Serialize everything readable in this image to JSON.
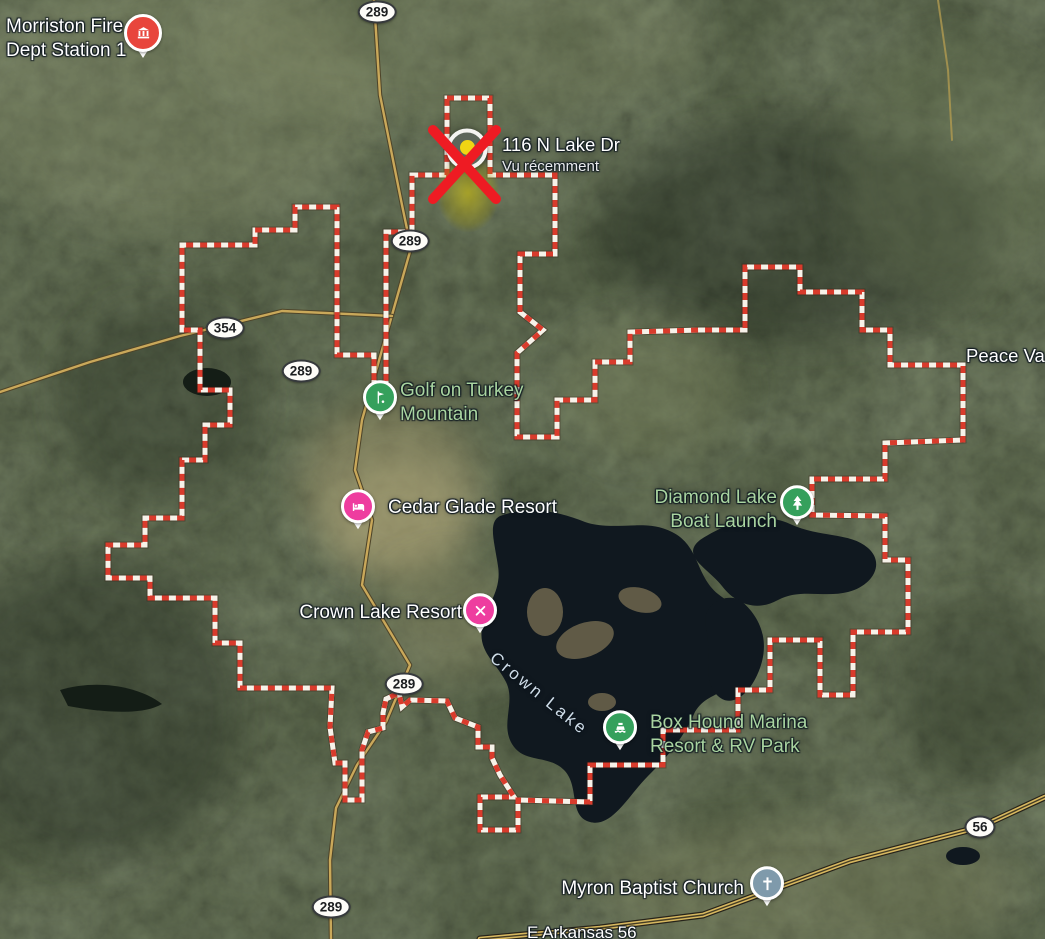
{
  "region": {
    "boundary_points": "447,98 490,98 490,175 555,175 555,254 520,254 520,312 543,330 517,353 517,437 557,437 557,400 595,400 595,362 630,362 630,332 700,330 745,330 745,267 800,267 800,292 862,292 862,330 890,330 890,365 963,365 963,440 885,443 885,479 812,479 812,515 885,516 885,560 908,560 908,632 853,632 853,695 820,695 820,640 770,640 770,690 738,690 738,730 663,730 663,765 590,765 590,802 518,800 518,830 480,830 480,797 514,797 500,775 492,758 492,747 478,747 478,727 455,718 447,701 410,700 402,707 399,693 386,699 383,713 383,728 368,732 362,750 362,800 345,800 345,763 335,763 330,727 332,688 240,688 240,643 215,643 215,598 150,598 150,578 108,578 108,545 145,545 145,518 182,518 182,460 205,460 205,425 230,425 230,390 200,390 200,330 182,330 182,245 255,245 255,230 295,230 295,207 337,207 337,355 374,355 374,392 386,392 386,232 412,232 412,175 447,175",
    "boundary_red": "#d93b2c",
    "boundary_white": "#f7f2e9"
  },
  "annotation": {
    "x_color": "#ee1b23"
  },
  "selected_place": {
    "name": "116 N Lake Dr",
    "status": "Vu récemment"
  },
  "places": [
    {
      "line1": "Morriston Fire",
      "line2": "Dept Station 1"
    },
    {
      "line1": "Golf on Turkey",
      "line2": "Mountain"
    },
    {
      "line1": "Cedar Glade Resort"
    },
    {
      "line1": "Crown Lake Resort"
    },
    {
      "line1": "Diamond Lake",
      "line2": "Boat Launch"
    },
    {
      "line1": "Box Hound Marina",
      "line2": "Resort & RV Park"
    },
    {
      "line1": "Myron Baptist Church"
    },
    {
      "line1": "Peace Va"
    }
  ],
  "map_labels": {
    "water": "Crown Lake",
    "street": "E Arkansas 56"
  },
  "road_shields": [
    {
      "label": "289"
    },
    {
      "label": "289"
    },
    {
      "label": "354"
    },
    {
      "label": "289"
    },
    {
      "label": "289"
    },
    {
      "label": "289"
    },
    {
      "label": "56"
    }
  ],
  "poi_colors": {
    "fire_red": "#e8453c",
    "outdoor_green": "#35a05c",
    "lodging_pink": "#ee3d9f",
    "church_gray": "#7f9aab",
    "label_green": "#a9d4a0",
    "recent_yellow": "#f0d514"
  }
}
